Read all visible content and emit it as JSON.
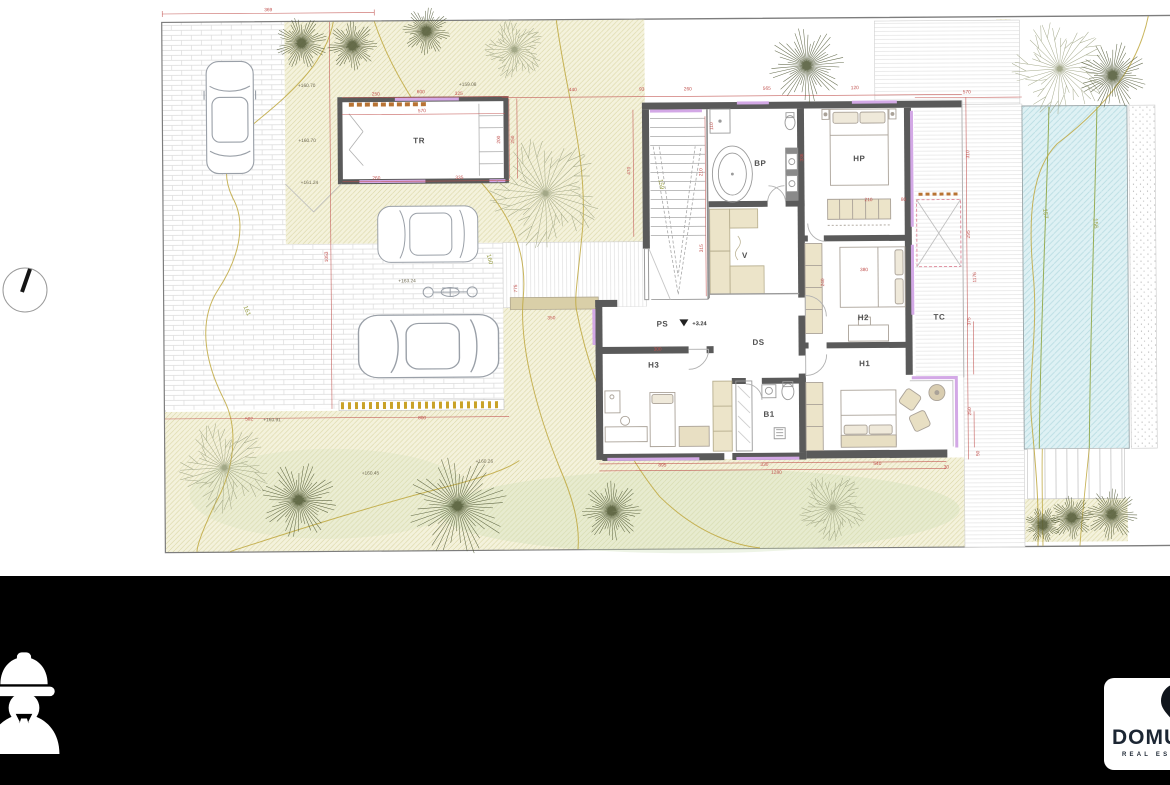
{
  "meta": {
    "type": "architectural site plan, upper floor"
  },
  "colors": {
    "dimension_red": "#c0504d",
    "contour_olive": "#b3a042",
    "pool_fill": "#def1f4",
    "pool_hatch": "#b9dde3",
    "pool_contour_green": "#96ad57",
    "wall_gray": "#5a5a5a",
    "window_violet": "#d3a8e6",
    "garden_fill": "#f4f2dc",
    "garden_line": "#d9d5a2",
    "brand_navy": "#1c2633",
    "brand_blue": "#4a90d9",
    "footer_black": "#000000"
  },
  "plan": {
    "room_labels": [
      {
        "t": "TR",
        "x": 422,
        "y": 145
      },
      {
        "t": "BP",
        "x": 763,
        "y": 170
      },
      {
        "t": "HP",
        "x": 862,
        "y": 166
      },
      {
        "t": "V",
        "x": 747,
        "y": 262
      },
      {
        "t": "PS",
        "x": 664,
        "y": 330
      },
      {
        "t": "DS",
        "x": 760,
        "y": 349
      },
      {
        "t": "H2",
        "x": 865,
        "y": 325
      },
      {
        "t": "TC",
        "x": 941,
        "y": 325
      },
      {
        "t": "H3",
        "x": 655,
        "y": 371
      },
      {
        "t": "H1",
        "x": 866,
        "y": 371
      },
      {
        "t": "B1",
        "x": 770,
        "y": 421
      }
    ],
    "level_marker": {
      "t": "+3.24",
      "x": 694,
      "y": 329
    },
    "elevation_labels": [
      {
        "t": "+160.70",
        "x": 310,
        "y": 88
      },
      {
        "t": "+159.08",
        "x": 471,
        "y": 88
      },
      {
        "t": "+160.70",
        "x": 310,
        "y": 143
      },
      {
        "t": "+161.24",
        "x": 312,
        "y": 185
      },
      {
        "t": "+163.24",
        "x": 409,
        "y": 284
      },
      {
        "t": "+160.91",
        "x": 273,
        "y": 422
      },
      {
        "t": "+160.45",
        "x": 371,
        "y": 476
      },
      {
        "t": "+160.26",
        "x": 485,
        "y": 465
      }
    ],
    "contour_labels": [
      {
        "t": "161",
        "x": 247,
        "y": 312,
        "rot": 68
      },
      {
        "t": "160",
        "x": 490,
        "y": 262,
        "rot": 75
      },
      {
        "t": "159",
        "x": 662,
        "y": 188,
        "rot": 80
      },
      {
        "t": "157",
        "x": 1046,
        "y": 220,
        "rot": 85
      },
      {
        "t": "156",
        "x": 1096,
        "y": 230,
        "rot": 85
      }
    ],
    "dimension_labels": [
      {
        "t": "369",
        "x": 272,
        "y": 12
      },
      {
        "t": "250",
        "x": 379,
        "y": 97
      },
      {
        "t": "600",
        "x": 424,
        "y": 95
      },
      {
        "t": "325",
        "x": 462,
        "y": 97
      },
      {
        "t": "570",
        "x": 425,
        "y": 114
      },
      {
        "t": "260",
        "x": 379,
        "y": 181
      },
      {
        "t": "335",
        "x": 462,
        "y": 181
      },
      {
        "t": "200",
        "x": 503,
        "y": 142,
        "rot": -90
      },
      {
        "t": "250",
        "x": 517,
        "y": 142,
        "rot": -90
      },
      {
        "t": "1053",
        "x": 330,
        "y": 258,
        "rot": -90
      },
      {
        "t": "502",
        "x": 250,
        "y": 421
      },
      {
        "t": "800",
        "x": 423,
        "y": 421
      },
      {
        "t": "440",
        "x": 576,
        "y": 94
      },
      {
        "t": "93",
        "x": 645,
        "y": 94
      },
      {
        "t": "260",
        "x": 691,
        "y": 94
      },
      {
        "t": "565",
        "x": 770,
        "y": 94
      },
      {
        "t": "120",
        "x": 858,
        "y": 94
      },
      {
        "t": "470",
        "x": 633,
        "y": 174,
        "rot": -90
      },
      {
        "t": "210",
        "x": 705,
        "y": 176,
        "rot": -90
      },
      {
        "t": "315",
        "x": 705,
        "y": 252,
        "rot": -90
      },
      {
        "t": "110",
        "x": 716,
        "y": 130,
        "rot": -90
      },
      {
        "t": "336",
        "x": 806,
        "y": 162,
        "rot": -90
      },
      {
        "t": "210",
        "x": 871,
        "y": 206
      },
      {
        "t": "80",
        "x": 906,
        "y": 206
      },
      {
        "t": "380",
        "x": 866,
        "y": 276
      },
      {
        "t": "240",
        "x": 826,
        "y": 287,
        "rot": -90
      },
      {
        "t": "775",
        "x": 519,
        "y": 291,
        "rot": -90
      },
      {
        "t": "350",
        "x": 553,
        "y": 322
      },
      {
        "t": "300",
        "x": 659,
        "y": 354
      },
      {
        "t": "570",
        "x": 970,
        "y": 99
      },
      {
        "t": "310",
        "x": 972,
        "y": 160,
        "rot": -90
      },
      {
        "t": "295",
        "x": 972,
        "y": 240,
        "rot": -90
      },
      {
        "t": "1176",
        "x": 978,
        "y": 283,
        "rot": -90
      },
      {
        "t": "375",
        "x": 972,
        "y": 327,
        "rot": -90
      },
      {
        "t": "250",
        "x": 972,
        "y": 417,
        "rot": -90
      },
      {
        "t": "50",
        "x": 980,
        "y": 459,
        "rot": -90
      },
      {
        "t": "895",
        "x": 663,
        "y": 470
      },
      {
        "t": "330",
        "x": 765,
        "y": 470
      },
      {
        "t": "540",
        "x": 878,
        "y": 470
      },
      {
        "t": "1280",
        "x": 777,
        "y": 478
      },
      {
        "t": "30",
        "x": 947,
        "y": 474
      }
    ],
    "trees": [
      {
        "x": 305,
        "y": 44,
        "r": 26,
        "type": "star"
      },
      {
        "x": 356,
        "y": 47,
        "r": 25,
        "type": "star"
      },
      {
        "x": 430,
        "y": 33,
        "r": 24,
        "type": "star"
      },
      {
        "x": 518,
        "y": 52,
        "r": 30,
        "type": "twig"
      },
      {
        "x": 810,
        "y": 70,
        "r": 38,
        "type": "star"
      },
      {
        "x": 1063,
        "y": 75,
        "r": 48,
        "type": "twig"
      },
      {
        "x": 1116,
        "y": 82,
        "r": 34,
        "type": "star"
      },
      {
        "x": 548,
        "y": 196,
        "r": 56,
        "type": "twig"
      },
      {
        "x": 225,
        "y": 468,
        "r": 46,
        "type": "twig"
      },
      {
        "x": 299,
        "y": 501,
        "r": 38,
        "type": "star"
      },
      {
        "x": 458,
        "y": 508,
        "r": 50,
        "type": "star"
      },
      {
        "x": 612,
        "y": 514,
        "r": 30,
        "type": "star"
      },
      {
        "x": 833,
        "y": 512,
        "r": 34,
        "type": "twig"
      },
      {
        "x": 1043,
        "y": 531,
        "r": 18,
        "type": "star"
      },
      {
        "x": 1072,
        "y": 524,
        "r": 22,
        "type": "star"
      },
      {
        "x": 1112,
        "y": 521,
        "r": 26,
        "type": "star"
      }
    ]
  },
  "footer": {
    "brand": {
      "name": "DOMUS",
      "tagline": "REAL ESTATE"
    },
    "icons": [
      "construction-worker-icon",
      "location-pin-icon"
    ]
  }
}
